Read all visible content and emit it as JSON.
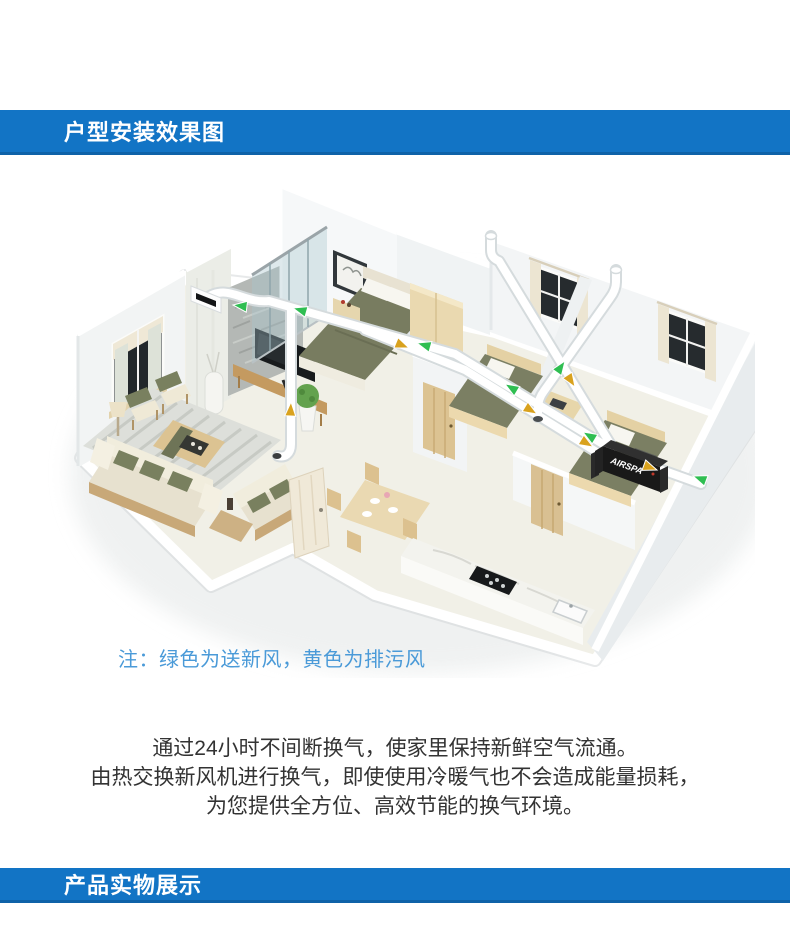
{
  "section_headers": {
    "install": {
      "label": "户型安装效果图"
    },
    "product": {
      "label": "产品实物展示"
    }
  },
  "floor_plan": {
    "note": "注：绿色为送新风，黄色为排污风",
    "unit_label": "AIRSPA",
    "legend": {
      "fresh_air": {
        "label": "送新风",
        "color": "#2fbe52"
      },
      "exhaust": {
        "label": "排污风",
        "color": "#d9a21e"
      }
    },
    "duct_color": "#ffffff"
  },
  "description": {
    "lines": {
      "0": "通过24小时不间断换气，使家里保持新鲜空气流通。",
      "1": "由热交换新风机进行换气，即使使用冷暖气也不会造成能量损耗，",
      "2": "为您提供全方位、高效节能的换气环境。"
    }
  },
  "colors": {
    "section_bar": "#1274c5",
    "note_text": "#4a9ad8",
    "body_text": "#333333"
  }
}
